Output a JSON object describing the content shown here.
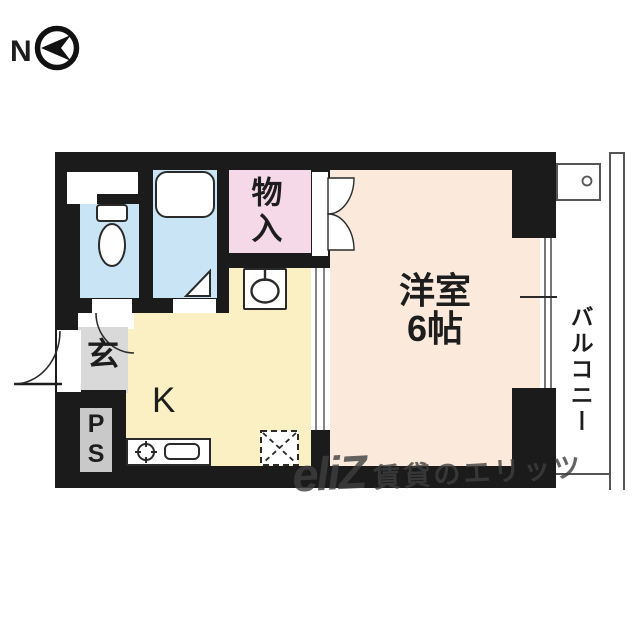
{
  "compass": {
    "label": "N"
  },
  "rooms": {
    "closet": {
      "label": "物入"
    },
    "western_room": {
      "label": "洋室",
      "size": "6帖"
    },
    "balcony": {
      "label": "バルコニー"
    },
    "kitchen": {
      "label": "K"
    },
    "entrance": {
      "label": "玄"
    },
    "pipe_space": {
      "label": "PS"
    }
  },
  "watermark": {
    "logo": "eliZ",
    "text": "賃貸のエリッツ"
  },
  "colors": {
    "wall": "#1b1b1b",
    "wet_area": "#c9e4f5",
    "closet": "#f6d9e9",
    "main_room": "#fbeadb",
    "kitchen": "#faf0c3",
    "entrance": "#d9d9d9",
    "ps_box": "#c9c9c9"
  },
  "icons": {
    "compass-arrow": "left-arrow-in-circle",
    "toilet": "tank-and-bowl",
    "bathtub": "rounded-rect",
    "water-heater": "circle-with-stem",
    "stove-burner": "circle-with-ticks",
    "kitchen-sink": "rounded-rect",
    "refrigerator-space": "dashed-box-with-x",
    "washer-pan-drain": "small-circle",
    "door-swing": "quarter-arc"
  }
}
